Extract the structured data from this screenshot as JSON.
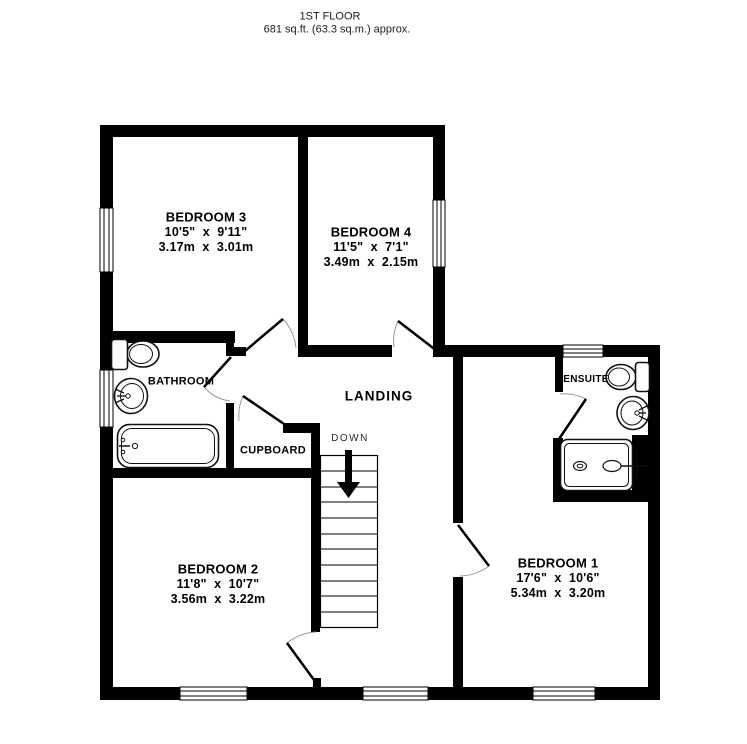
{
  "title": {
    "line1": "1ST FLOOR",
    "line2": "681 sq.ft. (63.3 sq.m.) approx."
  },
  "rooms": {
    "bedroom1": {
      "name": "BEDROOM 1",
      "imperial": "17'6\"  x  10'6\"",
      "metric": "5.34m  x  3.20m"
    },
    "bedroom2": {
      "name": "BEDROOM 2",
      "imperial": "11'8\"  x  10'7\"",
      "metric": "3.56m  x  3.22m"
    },
    "bedroom3": {
      "name": "BEDROOM 3",
      "imperial": "10'5\"  x  9'11\"",
      "metric": "3.17m  x  3.01m"
    },
    "bedroom4": {
      "name": "BEDROOM 4",
      "imperial": "11'5\"  x  7'1\"",
      "metric": "3.49m  x  2.15m"
    },
    "bathroom": {
      "name": "BATHROOM"
    },
    "ensuite": {
      "name": "ENSUITE"
    },
    "landing": {
      "name": "LANDING"
    },
    "cupboard": {
      "name": "CUPBOARD"
    }
  },
  "stairs": {
    "direction_label": "DOWN"
  },
  "colors": {
    "wall": "#000000",
    "background": "#ffffff",
    "door_arc": "#9a9a9a"
  }
}
